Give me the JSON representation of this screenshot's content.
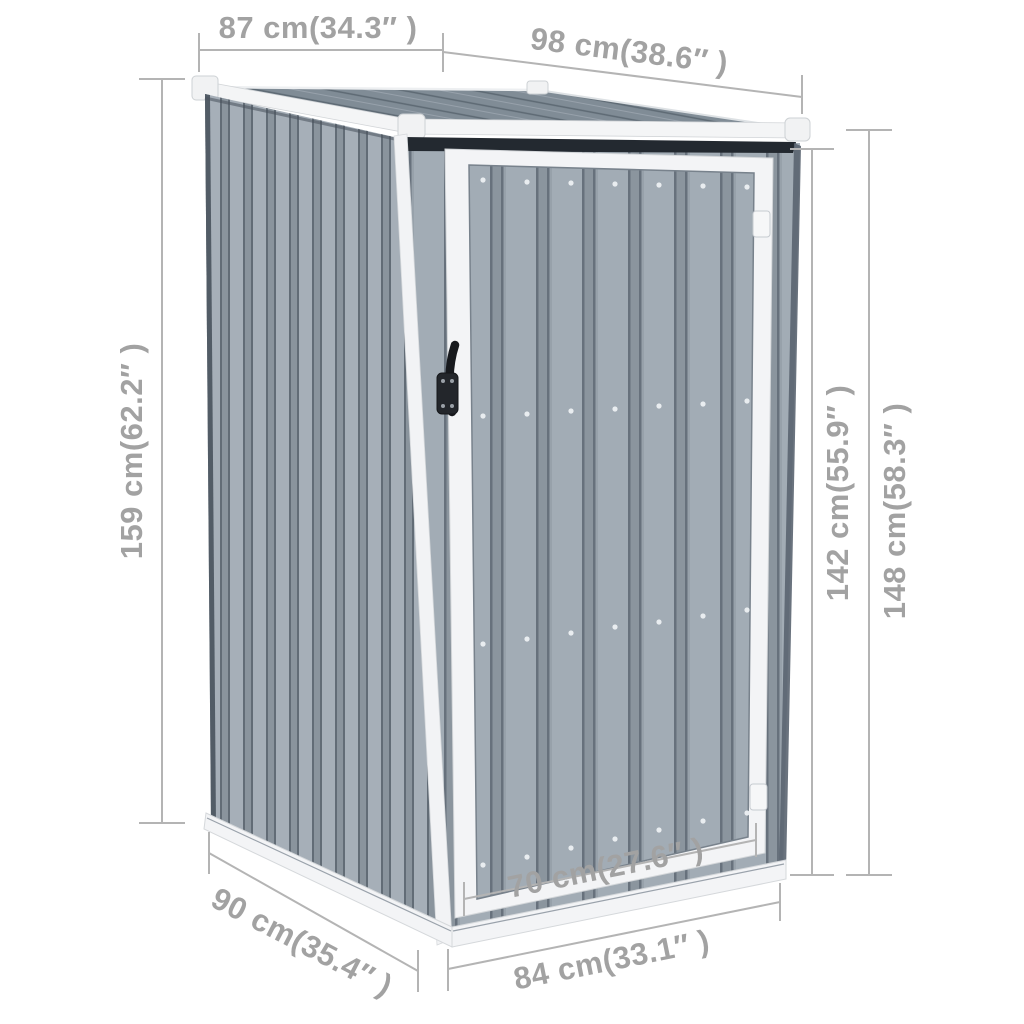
{
  "illustration": {
    "subject": "gray metal garden shed with pent roof and single hinged door, shown with measurement lines"
  },
  "dimensions": {
    "top_left": {
      "cm": 87,
      "inches": 34.3,
      "label": "87 cm(34.3″ )"
    },
    "top_right": {
      "cm": 98,
      "inches": 38.6,
      "label": "98 cm(38.6″ )"
    },
    "left": {
      "cm": 159,
      "inches": 62.2,
      "label": "159 cm(62.2″ )"
    },
    "right_inner": {
      "cm": 142,
      "inches": 55.9,
      "label": "142 cm(55.9″ )"
    },
    "right_outer": {
      "cm": 148,
      "inches": 58.3,
      "label": "148 cm(58.3″ )"
    },
    "bottom_left": {
      "cm": 90,
      "inches": 35.4,
      "label": "90 cm(35.4″ )"
    },
    "bottom_center": {
      "cm": 70,
      "inches": 27.6,
      "label": "70 cm(27.6″ )"
    },
    "bottom_right": {
      "cm": 84,
      "inches": 33.1,
      "label": "84 cm(33.1″ )"
    }
  },
  "colors": {
    "background": "#ffffff",
    "panel_light": "#a3adb6",
    "panel_groove": "#67717c",
    "roof_gray": "#808c96",
    "trim_white": "#f4f5f6",
    "handle_black": "#1c1f23",
    "dimension_line": "#b4b4b4",
    "dimension_text": "#a2a2a2"
  }
}
